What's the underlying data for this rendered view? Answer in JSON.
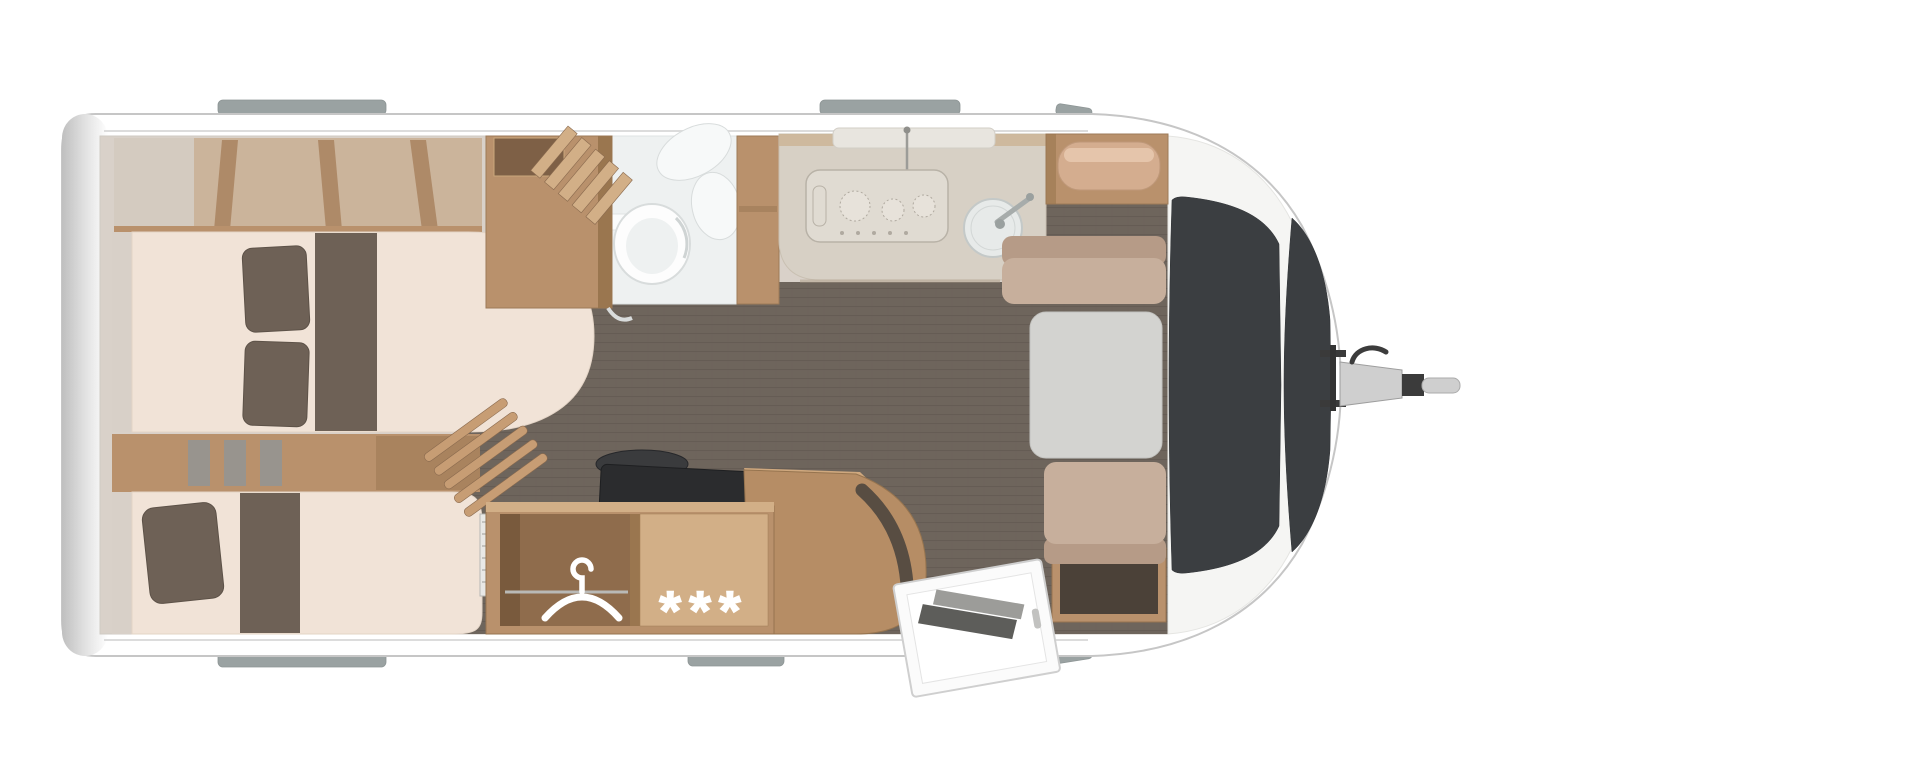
{
  "scene": {
    "type": "caravan floor plan",
    "view": "top-down",
    "hitch_side": "right"
  },
  "symbols": {
    "freezer_stars": "***",
    "hanger_icon": "clothes-hanger",
    "toilet_icon": "toilet-bowl",
    "sink_icon": "round-kitchen-sink",
    "cooktop_icon": "three-burner-hob"
  },
  "features": [
    {
      "name": "rear-bedroom",
      "items": [
        "overhead-lockers",
        "bed-top",
        "bed-bottom",
        "pillows",
        "step-console"
      ]
    },
    {
      "name": "bathroom",
      "items": [
        "wooden-cabinet",
        "louvre-rack",
        "washbasin",
        "toilet",
        "shelf"
      ]
    },
    {
      "name": "kitchen",
      "items": [
        "counter",
        "three-burner-hob",
        "round-sink",
        "faucet",
        "wall-ledge"
      ]
    },
    {
      "name": "midship-units",
      "items": [
        "slat-rack",
        "dark-cooktop",
        "wardrobe-with-hanger",
        "freezer-stars-compartment",
        "curved-island"
      ]
    },
    {
      "name": "front-dinette",
      "items": [
        "bench-rear",
        "table",
        "bench-front",
        "overhead-shelf"
      ]
    },
    {
      "name": "entry-door",
      "state": "open",
      "steps_visible": true
    },
    {
      "name": "front-windows",
      "count": 2
    },
    {
      "name": "tow-hitch",
      "state": "attached"
    }
  ],
  "palette": {
    "shell_stroke": "#c6c6c6",
    "tab_gray": "#9aa2a2",
    "wall_beige": "#d9d1c9",
    "floor": "#6e655c",
    "floor_line": "#5c544d",
    "wood": "#b9916c",
    "wood_dark": "#9a764f",
    "wood_light": "#d2af87",
    "mattress": "#f1e3d7",
    "cushion": "#6e6156",
    "bench_tan": "#c7af9c",
    "bench_back": "#b69b87",
    "table_gray": "#d3d3d0",
    "counter": "#d7d0c5",
    "fixture_white": "#eef1f1",
    "window_dark": "#3b3e41",
    "nose_wall": "#f5f5f3",
    "island_wood": "#b68d65",
    "cooktop_black": "#2b2c2e",
    "steel_gray": "#cfcfcf",
    "locker_tan": "#c9a57f"
  }
}
